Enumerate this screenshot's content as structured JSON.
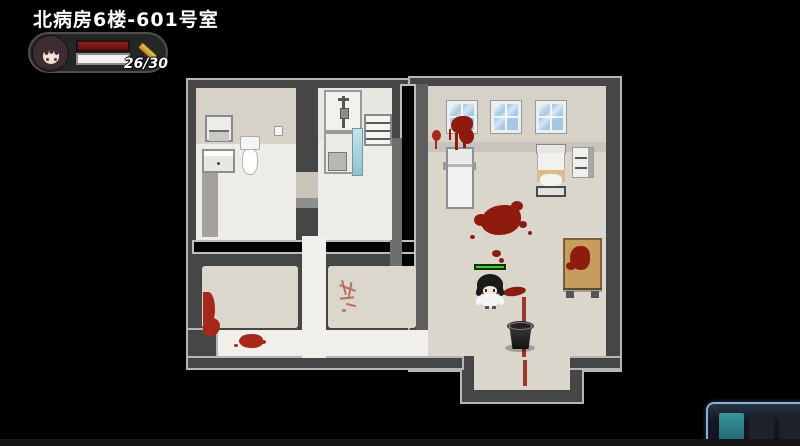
{
  "hud": {
    "location_title": "北病房6楼-601号室",
    "portrait": "dark-haired-girl-portrait",
    "weapon_icon": "scalpel-icon",
    "counter_text": "26/30",
    "counter_current": 26,
    "counter_max": 30,
    "bar_primary_color": "#7d1a1a",
    "bar_secondary_color": "#f4f2ef"
  },
  "player": {
    "sprite": "girl-black-hair-white-dress",
    "hp_bar_color": "#3fd32f",
    "hp_bar_fill_ratio": 1.0
  },
  "map": {
    "location": "北病房6楼-601号室",
    "rooms": [
      "bathroom-toilet-room",
      "bathroom-shower-room",
      "ward-room-601",
      "small-room-bottom-left",
      "small-room-bottom-right",
      "hallway"
    ],
    "objects": [
      "paper-dispenser",
      "wall-cup",
      "toilet",
      "sink-cabinet",
      "iv-stand-unit",
      "shower-glass",
      "wall-shelf",
      "window",
      "window",
      "window",
      "folding-screen",
      "hospital-bed",
      "nightstand-cabinet",
      "wooden-table",
      "bucket",
      "blood-pool",
      "blood-trail",
      "blood-smear",
      "blood-splat",
      "blood-handprint"
    ],
    "blood_color": "#8e1c0e",
    "floor_color": "#dad6cb",
    "wall_color": "#464646"
  },
  "item_window": {
    "border_color": "#8cb0d6",
    "slots": [
      {
        "name": "teal-item",
        "color": "#2e858c"
      },
      {
        "name": "empty-slot",
        "color": "#1d2129"
      },
      {
        "name": "empty-slot",
        "color": "#1d2129"
      }
    ]
  }
}
